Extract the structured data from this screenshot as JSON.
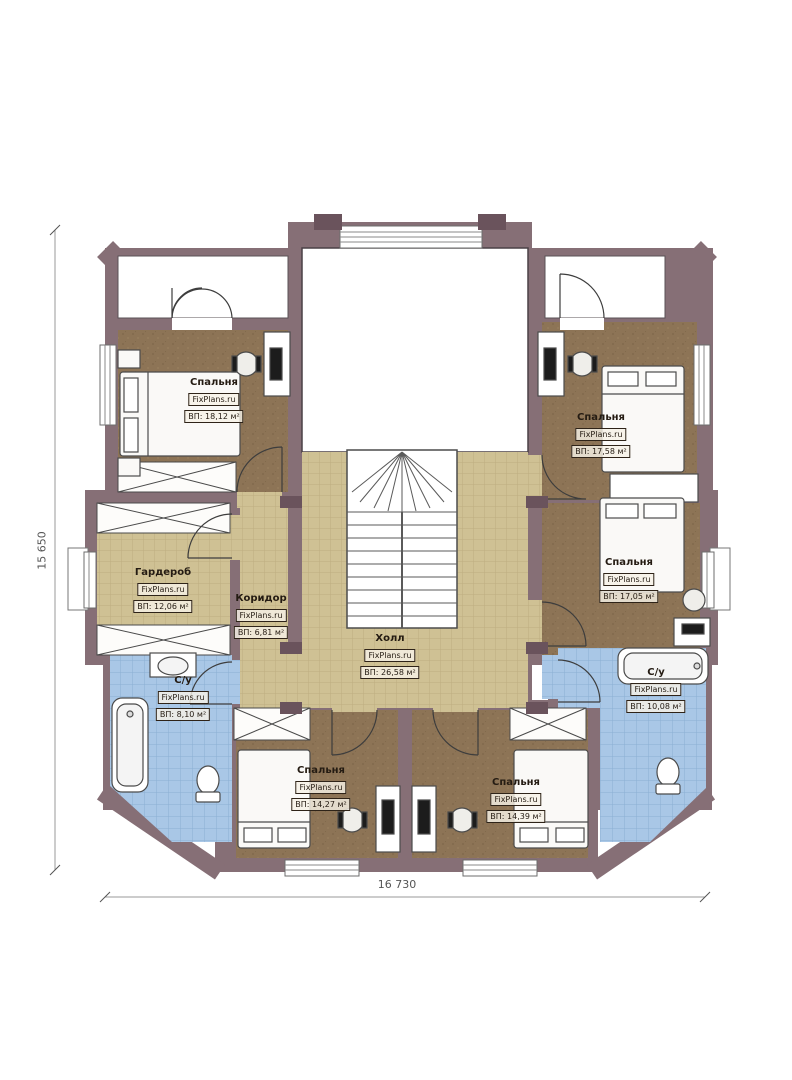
{
  "plan": {
    "watermark": "FixPlans.ru",
    "dimensions": {
      "height_label": "15 650",
      "width_label": "16 730"
    },
    "rooms": [
      {
        "id": "bedroom-top-left",
        "name": "Спальня",
        "watermark": "FixPlans.ru",
        "area_label": "ВП: 18,12 м²"
      },
      {
        "id": "bedroom-top-right",
        "name": "Спальня",
        "watermark": "FixPlans.ru",
        "area_label": "ВП: 17,58 м²"
      },
      {
        "id": "wardrobe",
        "name": "Гардероб",
        "watermark": "FixPlans.ru",
        "area_label": "ВП: 12,06 м²"
      },
      {
        "id": "corridor",
        "name": "Коридор",
        "watermark": "FixPlans.ru",
        "area_label": "ВП: 6,81 м²"
      },
      {
        "id": "hall",
        "name": "Холл",
        "watermark": "FixPlans.ru",
        "area_label": "ВП: 26,58 м²"
      },
      {
        "id": "bedroom-middle-right",
        "name": "Спальня",
        "watermark": "FixPlans.ru",
        "area_label": "ВП: 17,05 м²"
      },
      {
        "id": "bathroom-left",
        "name": "С/у",
        "watermark": "FixPlans.ru",
        "area_label": "ВП: 8,10 м²"
      },
      {
        "id": "bathroom-right",
        "name": "С/у",
        "watermark": "FixPlans.ru",
        "area_label": "ВП: 10,08 м²"
      },
      {
        "id": "bedroom-bottom-left",
        "name": "Спальня",
        "watermark": "FixPlans.ru",
        "area_label": "ВП: 14,27 м²"
      },
      {
        "id": "bedroom-bottom-right",
        "name": "Спальня",
        "watermark": "FixPlans.ru",
        "area_label": "ВП: 14,39 м²"
      }
    ],
    "colors": {
      "wall": "#866f76",
      "floor_wood": "#8d7456",
      "floor_tan": "#cfc194",
      "floor_tile": "#a9c7e6",
      "furniture_outline": "#4b4b4b"
    }
  }
}
